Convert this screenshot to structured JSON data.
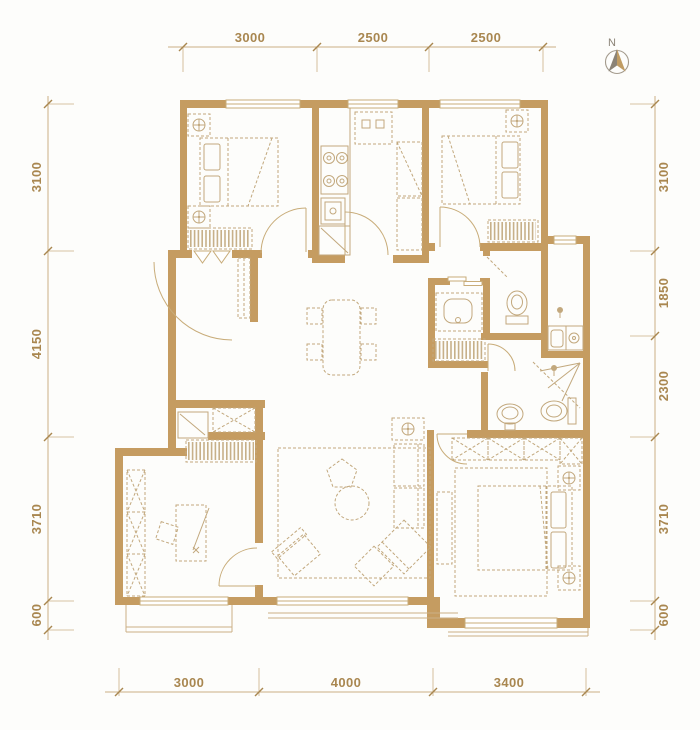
{
  "colors": {
    "wall": "#C59C61",
    "furniture_line": "#C2A87D",
    "door_window_line": "#C8AC79",
    "dimension_line": "#CBB086",
    "dimension_text": "#A98750",
    "north_gray": "#8B8376",
    "north_gold": "#C09C63",
    "background": "#FDFDFB"
  },
  "north": {
    "label": "N"
  },
  "dimensions": {
    "top": [
      "3000",
      "2500",
      "2500"
    ],
    "bottom": [
      "3000",
      "4000",
      "3400"
    ],
    "left": [
      "3100",
      "4150",
      "3710",
      "600"
    ],
    "right": [
      "3100",
      "1850",
      "2300",
      "3710",
      "600"
    ]
  }
}
